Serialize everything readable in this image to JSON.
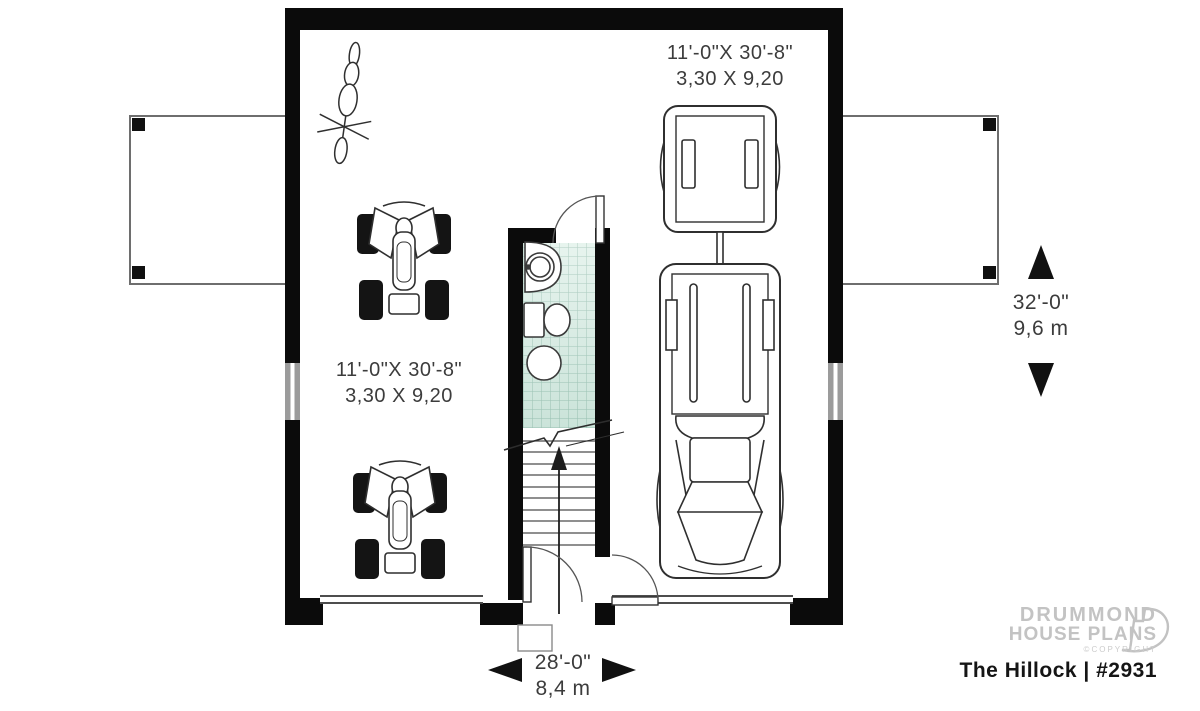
{
  "plan": {
    "left_bay": {
      "imperial": "11'-0\"X 30'-8\"",
      "metric": "3,30 X 9,20"
    },
    "right_bay": {
      "imperial": "11'-0\"X 30'-8\"",
      "metric": "3,30 X 9,20"
    },
    "overall_depth": {
      "imperial": "32'-0\"",
      "metric": "9,6 m"
    },
    "overall_width": {
      "imperial": "28'-0\"",
      "metric": "8,4 m"
    }
  },
  "branding": {
    "brand_line1": "DRUMMOND",
    "brand_line2": "HOUSE PLANS",
    "copyright": "©COPYRIGHT",
    "plan_name": "The Hillock | #2931"
  },
  "colors": {
    "wall": "#0b0b0b",
    "line": "#3a3a3a",
    "bath_tile": "#ddefe7",
    "dim_text": "#3c3c3c",
    "brand_gray": "#c3c3c3"
  }
}
